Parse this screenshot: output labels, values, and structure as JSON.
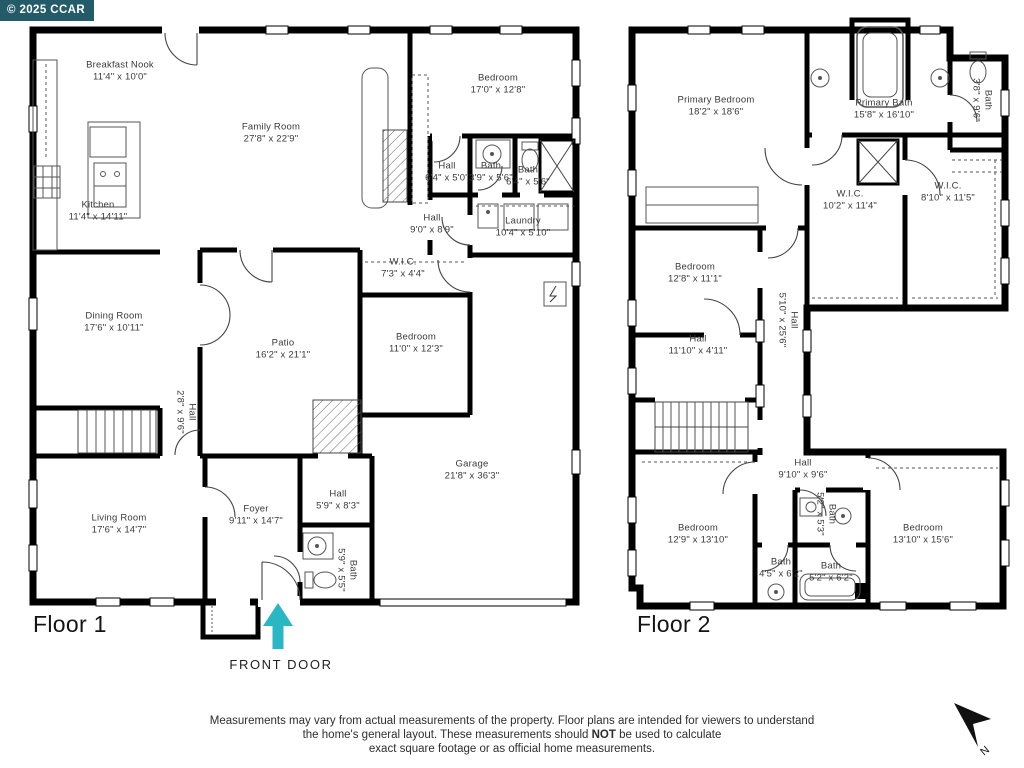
{
  "copyright": "© 2025 CCAR",
  "compass": {
    "n": "N"
  },
  "colors": {
    "accent": "#2ab7c4",
    "copyright_bg": "#235b69",
    "wall": "#000000"
  },
  "floor1": {
    "label": "Floor 1",
    "front_door_label": "FRONT DOOR",
    "rooms": [
      {
        "name": "Breakfast Nook",
        "dims": "11'4\" x 10'0\""
      },
      {
        "name": "Family Room",
        "dims": "27'8\" x 22'9\""
      },
      {
        "name": "Kitchen",
        "dims": "11'4\" x 14'11\""
      },
      {
        "name": "Bedroom",
        "dims": "17'0\" x 12'8\""
      },
      {
        "name": "Hall",
        "dims": "6'4\" x 5'0\""
      },
      {
        "name": "Bath",
        "dims": "3'9\" x 5'6\""
      },
      {
        "name": "Bath",
        "dims": "6'4\" x 5'6\""
      },
      {
        "name": "Hall",
        "dims": "9'0\" x 8'9\""
      },
      {
        "name": "Laundry",
        "dims": "10'4\" x 5'10\""
      },
      {
        "name": "W.I.C.",
        "dims": "7'3\" x 4'4\""
      },
      {
        "name": "Dining Room",
        "dims": "17'6\" x 10'11\""
      },
      {
        "name": "Patio",
        "dims": "16'2\" x 21'1\""
      },
      {
        "name": "Bedroom",
        "dims": "11'0\" x 12'3\""
      },
      {
        "name": "Hall",
        "dims": "2'8\" x 9'6\""
      },
      {
        "name": "Living Room",
        "dims": "17'6\" x 14'7\""
      },
      {
        "name": "Foyer",
        "dims": "9'11\" x 14'7\""
      },
      {
        "name": "Hall",
        "dims": "5'9\" x 8'3\""
      },
      {
        "name": "Bath",
        "dims": "5'9\" x 5'5\""
      },
      {
        "name": "Garage",
        "dims": "21'8\" x 36'3\""
      }
    ]
  },
  "floor2": {
    "label": "Floor 2",
    "rooms": [
      {
        "name": "Primary Bedroom",
        "dims": "18'2\" x 18'6\""
      },
      {
        "name": "Primary Bath",
        "dims": "15'8\" x 16'10\""
      },
      {
        "name": "Bath",
        "dims": "3'8\" x 9'6\""
      },
      {
        "name": "W.I.C.",
        "dims": "10'2\" x 11'4\""
      },
      {
        "name": "W.I.C.",
        "dims": "8'10\" x 11'5\""
      },
      {
        "name": "Bedroom",
        "dims": "12'8\" x 11'1\""
      },
      {
        "name": "Hall",
        "dims": "11'10\" x 4'11\""
      },
      {
        "name": "Hall",
        "dims": "5'10\" x 25'6\""
      },
      {
        "name": "Hall",
        "dims": "9'10\" x 9'6\""
      },
      {
        "name": "Bedroom",
        "dims": "12'9\" x 13'10\""
      },
      {
        "name": "Bedroom",
        "dims": "13'10\" x 15'6\""
      },
      {
        "name": "Bath",
        "dims": "4'5\" x 6'2\""
      },
      {
        "name": "Bath",
        "dims": "5'2\" x 6'2\""
      },
      {
        "name": "Bath",
        "dims": "5'2\" x 5'3\""
      }
    ]
  },
  "footer": {
    "line1": "Measurements may vary from actual measurements of the property. Floor plans are intended for viewers to understand",
    "line2_pre": "the home's general layout.  These measurements should ",
    "line2_bold": "NOT",
    "line2_post": " be used to calculate",
    "line3": "exact square footage or as official home measurements."
  }
}
